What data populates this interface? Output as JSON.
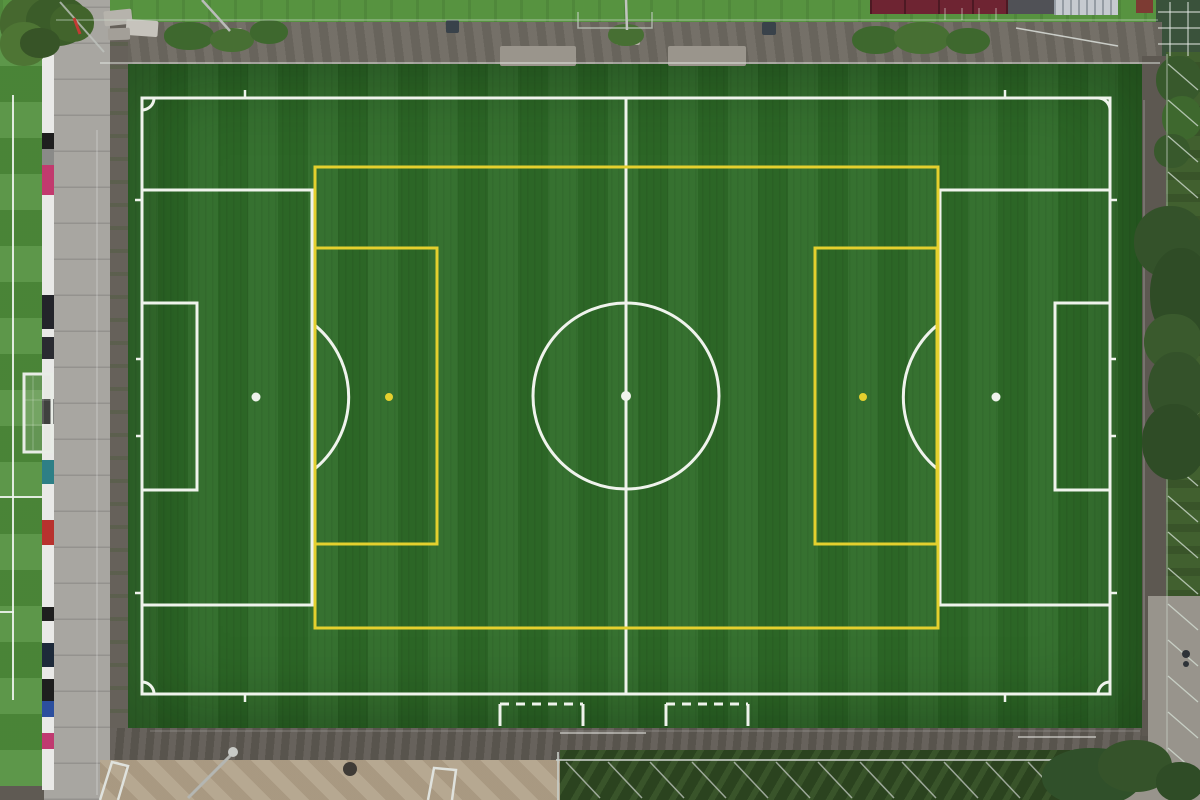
{
  "scene_type": "aerial-photo-soccer-pitch",
  "palette": {
    "turf": "#2e6b28",
    "grass": "#4f8e3b",
    "grasstop": "#579340",
    "pathtop": "#6f6a62",
    "walkway": "#a8a6a1",
    "gravelmid": "#66615a",
    "gravelbottom": "#5f5a53",
    "sand": "#b1a189",
    "veg": "#2b431f",
    "fencezone": "#41602f",
    "pathright": "#5d5851",
    "pathlight": "#98948c",
    "roof": "#6e2432",
    "roofdark": "#505156",
    "container": "#c6cad0",
    "redbox": "#7d3b33",
    "pad": "#9a958c",
    "whiteline": "#eff3ec",
    "yellowline": "#e4d02e"
  },
  "barrier": {
    "segments": [
      {
        "c": "#e9e9e7",
        "h": 78
      },
      {
        "c": "#1e1e1e",
        "h": 16
      },
      {
        "c": "#8a8a88",
        "h": 16
      },
      {
        "c": "#c23a6e",
        "h": 30
      },
      {
        "c": "#e9e9e7",
        "h": 100
      },
      {
        "c": "#23242a",
        "h": 34
      },
      {
        "c": "#e9e9e7",
        "h": 8
      },
      {
        "c": "#2a2b31",
        "h": 22
      },
      {
        "c": "#e9e9e7",
        "h": 40
      },
      {
        "c": "#1e1e1e",
        "h": 25
      },
      {
        "c": "#e9e9e7",
        "h": 36
      },
      {
        "c": "#2e7f86",
        "h": 24
      },
      {
        "c": "#e9e9e7",
        "h": 36
      },
      {
        "c": "#b8322e",
        "h": 25
      },
      {
        "c": "#e9e9e7",
        "h": 62
      },
      {
        "c": "#1e1e1e",
        "h": 14
      },
      {
        "c": "#e9e9e7",
        "h": 22
      },
      {
        "c": "#1d2a3a",
        "h": 24
      },
      {
        "c": "#e9e9e7",
        "h": 12
      },
      {
        "c": "#1e1e1e",
        "h": 22
      },
      {
        "c": "#2c4f9e",
        "h": 16
      },
      {
        "c": "#e9e9e7",
        "h": 16
      },
      {
        "c": "#c03a70",
        "h": 16
      },
      {
        "c": "#e9e9e7",
        "h": 41
      }
    ]
  },
  "markings": {
    "surround": [
      {
        "t": "line",
        "x1": 56,
        "y1": 20,
        "x2": 1158,
        "y2": 20,
        "s": "rgba(205,220,205,0.45)",
        "w": 1.5,
        "n": "top-fence-line"
      },
      {
        "t": "line",
        "x1": 100,
        "y1": 63,
        "x2": 1160,
        "y2": 63,
        "s": "rgba(235,240,235,0.6)",
        "w": 1.5,
        "n": "top-rail-line"
      },
      {
        "t": "line",
        "x1": 97,
        "y1": 130,
        "x2": 97,
        "y2": 795,
        "s": "rgba(255,255,255,0.35)",
        "w": 1,
        "n": "walkway-joint-line"
      },
      {
        "t": "line",
        "x1": 60,
        "y1": 2,
        "x2": 104,
        "y2": 52,
        "s": "rgba(190,195,190,0.8)",
        "w": 2,
        "n": "corner-fence-diagonal"
      },
      {
        "t": "line",
        "x1": 74,
        "y1": 18,
        "x2": 80,
        "y2": 34,
        "s": "#c23b34",
        "w": 3,
        "n": "striped-marker-pole"
      },
      {
        "t": "line",
        "x1": 202,
        "y1": 0,
        "x2": 230,
        "y2": 31,
        "s": "#b9bcb8",
        "w": 2.5,
        "n": "floodlight-pole-topleft"
      },
      {
        "t": "path",
        "d": "M578 12 L578 28 L652 28 L652 12",
        "s": "rgba(200,210,200,0.7)",
        "w": 1.5,
        "n": "top-gate-frame"
      },
      {
        "t": "line",
        "x1": 626,
        "y1": 0,
        "x2": 627,
        "y2": 30,
        "s": "#c2c4c0",
        "w": 2.5,
        "n": "floodlight-pole-topcenter"
      },
      {
        "t": "series",
        "x0": 945,
        "y0": 8,
        "dx": 17,
        "dy": 0,
        "count": 4,
        "lx": 0,
        "ly": 12,
        "s": "rgba(230,230,225,0.6)",
        "w": 1,
        "n": "parking-line"
      },
      {
        "t": "line",
        "x1": 1016,
        "y1": 28,
        "x2": 1118,
        "y2": 46,
        "s": "rgba(225,230,225,0.8)",
        "w": 1.5,
        "n": "railing-diagonal-topright"
      },
      {
        "t": "line",
        "x1": 1158,
        "y1": 12,
        "x2": 1200,
        "y2": 12,
        "s": "rgba(230,235,230,0.8)",
        "w": 1.2,
        "n": "court-line"
      },
      {
        "t": "line",
        "x1": 1158,
        "y1": 28,
        "x2": 1200,
        "y2": 28,
        "s": "rgba(230,235,230,0.8)",
        "w": 1.2,
        "n": "court-line"
      },
      {
        "t": "line",
        "x1": 1158,
        "y1": 44,
        "x2": 1200,
        "y2": 44,
        "s": "rgba(230,235,230,0.8)",
        "w": 1.2,
        "n": "court-line"
      },
      {
        "t": "line",
        "x1": 1170,
        "y1": 2,
        "x2": 1170,
        "y2": 56,
        "s": "rgba(230,235,230,0.8)",
        "w": 1.2,
        "n": "court-line"
      },
      {
        "t": "line",
        "x1": 1188,
        "y1": 2,
        "x2": 1188,
        "y2": 56,
        "s": "rgba(230,235,230,0.8)",
        "w": 1.2,
        "n": "court-line"
      },
      {
        "t": "line",
        "x1": 1167,
        "y1": 54,
        "x2": 1167,
        "y2": 762,
        "s": "rgba(200,210,200,0.5)",
        "w": 1.5,
        "n": "right-fence-line"
      },
      {
        "t": "series",
        "x0": 1168,
        "y0": 64,
        "dx": 0,
        "dy": 36,
        "count": 20,
        "lx": 30,
        "ly": 26,
        "s": "rgba(215,225,215,0.75)",
        "w": 1.3,
        "n": "right-fence-brace"
      },
      {
        "t": "line",
        "x1": 556,
        "y1": 760,
        "x2": 1146,
        "y2": 760,
        "s": "rgba(200,205,200,0.8)",
        "w": 2,
        "n": "ballstop-cage-rail"
      },
      {
        "t": "line",
        "x1": 558,
        "y1": 752,
        "x2": 558,
        "y2": 800,
        "s": "rgba(200,205,200,0.8)",
        "w": 2,
        "n": "ballstop-cage-post"
      },
      {
        "t": "series",
        "x0": 566,
        "y0": 762,
        "dx": 42,
        "dy": 0,
        "count": 12,
        "lx": 34,
        "ly": 36,
        "s": "rgba(205,210,205,0.7)",
        "w": 1.5,
        "n": "ballstop-cage-brace"
      },
      {
        "t": "line",
        "x1": 13,
        "y1": 95,
        "x2": 13,
        "y2": 700,
        "s": "rgba(240,245,240,0.9)",
        "w": 2,
        "n": "adjacent-pitch-touchline"
      },
      {
        "t": "line",
        "x1": 0,
        "y1": 497,
        "x2": 42,
        "y2": 497,
        "s": "rgba(240,245,240,0.9)",
        "w": 2,
        "n": "adjacent-pitch-line"
      },
      {
        "t": "line",
        "x1": 0,
        "y1": 612,
        "x2": 14,
        "y2": 612,
        "s": "rgba(240,245,240,0.9)",
        "w": 2,
        "n": "adjacent-pitch-line"
      },
      {
        "t": "rect",
        "x": 24,
        "y": 374,
        "w": 28,
        "h": 78,
        "s": "#e8ece6",
        "w2": 0,
        "w_": 0,
        "wd": 0,
        "wdt": 0,
        "f": "rgba(220,228,218,0.18)",
        "n": "adjacent-pitch-goal"
      },
      {
        "t": "line",
        "x1": 33,
        "y1": 376,
        "x2": 33,
        "y2": 450,
        "s": "rgba(255,255,255,0.35)",
        "w": 0.8,
        "n": "goal-net-line"
      },
      {
        "t": "line",
        "x1": 43,
        "y1": 376,
        "x2": 43,
        "y2": 450,
        "s": "rgba(255,255,255,0.35)",
        "w": 0.8,
        "n": "goal-net-line"
      },
      {
        "t": "line",
        "x1": 25,
        "y1": 400,
        "x2": 51,
        "y2": 400,
        "s": "rgba(255,255,255,0.3)",
        "w": 0.8,
        "n": "goal-net-line"
      },
      {
        "t": "line",
        "x1": 25,
        "y1": 425,
        "x2": 51,
        "y2": 425,
        "s": "rgba(255,255,255,0.3)",
        "w": 0.8,
        "n": "goal-net-line"
      },
      {
        "t": "path",
        "d": "M100 800 L112 762 L128 766 L118 800",
        "s": "#dfe2dd",
        "w": 2.5,
        "n": "stored-bench-frame"
      },
      {
        "t": "path",
        "d": "M428 800 L434 768 L456 770 L452 800",
        "s": "#dfe2dd",
        "w": 2.5,
        "n": "stored-bench-frame"
      },
      {
        "t": "line",
        "x1": 188,
        "y1": 798,
        "x2": 232,
        "y2": 754,
        "s": "#b4b6b2",
        "w": 3,
        "n": "floodlight-pole-bottom"
      },
      {
        "t": "circle",
        "cx": 233,
        "cy": 752,
        "r": 5,
        "f": "#c8cac6",
        "n": "floodlight-lamp-head"
      },
      {
        "t": "circle",
        "cx": 350,
        "cy": 769,
        "r": 7,
        "f": "#3f3b36",
        "n": "manhole-cover"
      },
      {
        "t": "line",
        "x1": 560,
        "y1": 733,
        "x2": 646,
        "y2": 733,
        "s": "rgba(240,240,235,0.5)",
        "w": 2,
        "n": "path-paint-mark"
      },
      {
        "t": "line",
        "x1": 1018,
        "y1": 737,
        "x2": 1096,
        "y2": 737,
        "s": "rgba(240,240,235,0.5)",
        "w": 2,
        "n": "path-paint-mark"
      },
      {
        "t": "line",
        "x1": 1144,
        "y1": 100,
        "x2": 1144,
        "y2": 700,
        "s": "rgba(255,255,255,0.22)",
        "w": 1.5,
        "n": "turf-edge-seam"
      },
      {
        "t": "line",
        "x1": 150,
        "y1": 731,
        "x2": 1140,
        "y2": 731,
        "s": "rgba(255,255,255,0.16)",
        "w": 1.5,
        "n": "turf-edge-seam"
      },
      {
        "t": "circle",
        "cx": 1186,
        "cy": 654,
        "r": 4,
        "f": "#2e3338",
        "n": "person-on-path"
      },
      {
        "t": "circle",
        "cx": 1186,
        "cy": 664,
        "r": 3,
        "f": "#2e3338",
        "n": "person-on-path"
      }
    ],
    "white": [
      {
        "t": "rect",
        "x": 142,
        "y": 98,
        "w": 968,
        "h": 596,
        "n": "pitch-boundary"
      },
      {
        "t": "line",
        "x1": 626,
        "y1": 98,
        "x2": 626,
        "y2": 694,
        "n": "halfway-line"
      },
      {
        "t": "circle",
        "cx": 626,
        "cy": 396,
        "r": 93,
        "n": "center-circle"
      },
      {
        "t": "circle",
        "cx": 626,
        "cy": 396,
        "r": 3.5,
        "f": "line",
        "n": "center-spot"
      },
      {
        "t": "rect",
        "x": 142,
        "y": 190,
        "w": 170,
        "h": 415,
        "n": "penalty-area-left"
      },
      {
        "t": "rect",
        "x": 940,
        "y": 190,
        "w": 170,
        "h": 415,
        "n": "penalty-area-right"
      },
      {
        "t": "rect",
        "x": 142,
        "y": 303,
        "w": 55,
        "h": 187,
        "n": "goal-area-left"
      },
      {
        "t": "rect",
        "x": 1055,
        "y": 303,
        "w": 55,
        "h": 187,
        "n": "goal-area-right"
      },
      {
        "t": "circle",
        "cx": 256,
        "cy": 397,
        "r": 3,
        "f": "line",
        "n": "penalty-spot-left"
      },
      {
        "t": "circle",
        "cx": 996,
        "cy": 397,
        "r": 3,
        "f": "line",
        "n": "penalty-spot-right"
      },
      {
        "t": "path",
        "d": "M312 323 A93 93 0 0 1 312 471",
        "n": "penalty-arc-left"
      },
      {
        "t": "path",
        "d": "M940 323 A93 93 0 0 0 940 471",
        "n": "penalty-arc-right"
      },
      {
        "t": "path",
        "d": "M142 110 A12 12 0 0 0 154 98",
        "n": "corner-arc-tl"
      },
      {
        "t": "path",
        "d": "M1098 98 A12 12 0 0 1 1110 110",
        "n": "corner-arc-tr"
      },
      {
        "t": "path",
        "d": "M1110 682 A12 12 0 0 0 1098 694",
        "n": "corner-arc-br"
      },
      {
        "t": "path",
        "d": "M154 694 A12 12 0 0 0 142 682",
        "n": "corner-arc-bl"
      },
      {
        "t": "line",
        "x1": 245,
        "y1": 90,
        "x2": 245,
        "y2": 97,
        "w": 2.5,
        "n": "distance-tick"
      },
      {
        "t": "line",
        "x1": 1005,
        "y1": 90,
        "x2": 1005,
        "y2": 97,
        "w": 2.5,
        "n": "distance-tick"
      },
      {
        "t": "line",
        "x1": 245,
        "y1": 695,
        "x2": 245,
        "y2": 702,
        "w": 2.5,
        "n": "distance-tick"
      },
      {
        "t": "line",
        "x1": 1005,
        "y1": 695,
        "x2": 1005,
        "y2": 702,
        "w": 2.5,
        "n": "distance-tick"
      },
      {
        "t": "line",
        "x1": 135,
        "y1": 200,
        "x2": 142,
        "y2": 200,
        "w": 2.5,
        "n": "distance-tick"
      },
      {
        "t": "line",
        "x1": 135,
        "y1": 593,
        "x2": 142,
        "y2": 593,
        "w": 2.5,
        "n": "distance-tick"
      },
      {
        "t": "line",
        "x1": 1110,
        "y1": 200,
        "x2": 1117,
        "y2": 200,
        "w": 2.5,
        "n": "distance-tick"
      },
      {
        "t": "line",
        "x1": 1110,
        "y1": 593,
        "x2": 1117,
        "y2": 593,
        "w": 2.5,
        "n": "distance-tick"
      },
      {
        "t": "line",
        "x1": 136,
        "y1": 359,
        "x2": 142,
        "y2": 359,
        "w": 2.5,
        "n": "goalpost-tick"
      },
      {
        "t": "line",
        "x1": 136,
        "y1": 436,
        "x2": 142,
        "y2": 436,
        "w": 2.5,
        "n": "goalpost-tick"
      },
      {
        "t": "line",
        "x1": 1110,
        "y1": 359,
        "x2": 1116,
        "y2": 359,
        "w": 2.5,
        "n": "goalpost-tick"
      },
      {
        "t": "line",
        "x1": 1110,
        "y1": 436,
        "x2": 1116,
        "y2": 436,
        "w": 2.5,
        "n": "goalpost-tick"
      },
      {
        "t": "line",
        "x1": 500,
        "y1": 704,
        "x2": 583,
        "y2": 704,
        "da": "9 7",
        "n": "substitution-box-dashed-edge"
      },
      {
        "t": "line",
        "x1": 500,
        "y1": 704,
        "x2": 500,
        "y2": 726,
        "n": "substitution-box-side"
      },
      {
        "t": "line",
        "x1": 583,
        "y1": 704,
        "x2": 583,
        "y2": 726,
        "n": "substitution-box-side"
      },
      {
        "t": "line",
        "x1": 666,
        "y1": 704,
        "x2": 748,
        "y2": 704,
        "da": "9 7",
        "n": "substitution-box-dashed-edge"
      },
      {
        "t": "line",
        "x1": 666,
        "y1": 704,
        "x2": 666,
        "y2": 726,
        "n": "substitution-box-side"
      },
      {
        "t": "line",
        "x1": 748,
        "y1": 704,
        "x2": 748,
        "y2": 726,
        "n": "substitution-box-side"
      }
    ],
    "yellow": [
      {
        "t": "rect",
        "x": 315,
        "y": 167,
        "w": 623,
        "h": 461,
        "n": "yellow-outer-boundary"
      },
      {
        "t": "rect",
        "x": 315,
        "y": 248,
        "w": 122,
        "h": 296,
        "n": "yellow-box-left"
      },
      {
        "t": "rect",
        "x": 815,
        "y": 248,
        "w": 122,
        "h": 296,
        "n": "yellow-box-right"
      },
      {
        "t": "circle",
        "cx": 389,
        "cy": 397,
        "r": 2.5,
        "f": "line",
        "n": "yellow-spot-left"
      },
      {
        "t": "circle",
        "cx": 863,
        "cy": 397,
        "r": 2.5,
        "f": "line",
        "n": "yellow-spot-right"
      }
    ]
  },
  "props": {
    "pads": [
      [
        500,
        46,
        76,
        20
      ],
      [
        668,
        46,
        78,
        20
      ]
    ],
    "bases": [
      [
        224,
        28,
        18,
        17
      ],
      [
        616,
        28,
        24,
        17
      ]
    ],
    "bins": [
      [
        446,
        20,
        13,
        13
      ],
      [
        762,
        22,
        14,
        13
      ]
    ],
    "benches_tl": [
      [
        104,
        10,
        28,
        15,
        -6,
        "#b6b3ac"
      ],
      [
        126,
        20,
        32,
        16,
        4,
        "#c6c3bc"
      ],
      [
        108,
        28,
        22,
        12,
        -2,
        "#a39f98"
      ]
    ],
    "bushes": [
      [
        164,
        22,
        50,
        28,
        "#3e682e"
      ],
      [
        210,
        28,
        44,
        24,
        "#476f33"
      ],
      [
        250,
        20,
        38,
        24,
        "#3e682e"
      ],
      [
        608,
        24,
        36,
        22,
        "#476f33"
      ],
      [
        852,
        26,
        48,
        28,
        "#3e682e"
      ],
      [
        894,
        22,
        56,
        32,
        "#476f33"
      ],
      [
        946,
        28,
        44,
        26,
        "#3e682e"
      ],
      [
        1156,
        56,
        46,
        48,
        "#38592c"
      ],
      [
        1162,
        96,
        40,
        44,
        "#3e682e"
      ],
      [
        1154,
        134,
        36,
        34,
        "#38592c"
      ]
    ],
    "trees_tl": [
      [
        0,
        -6,
        66,
        60,
        "#46682f"
      ],
      [
        26,
        -4,
        62,
        50,
        "#3b5c29"
      ],
      [
        0,
        22,
        48,
        44,
        "#4e7534"
      ],
      [
        50,
        4,
        44,
        38,
        "#42642c"
      ],
      [
        20,
        28,
        40,
        30,
        "#375427"
      ]
    ],
    "trees_right": [
      [
        1134,
        206,
        72,
        72,
        "#34522a"
      ],
      [
        1150,
        248,
        62,
        92,
        "#2f4c26"
      ],
      [
        1144,
        314,
        58,
        56,
        "#3a5a2d"
      ],
      [
        1148,
        352,
        58,
        72,
        "#34522a"
      ],
      [
        1142,
        404,
        64,
        76,
        "#2f4c26"
      ]
    ],
    "trees_br": [
      [
        1042,
        748,
        100,
        58,
        "#30502a"
      ],
      [
        1098,
        740,
        74,
        52,
        "#35532a"
      ],
      [
        1156,
        762,
        48,
        40,
        "#2f4c26"
      ]
    ]
  }
}
